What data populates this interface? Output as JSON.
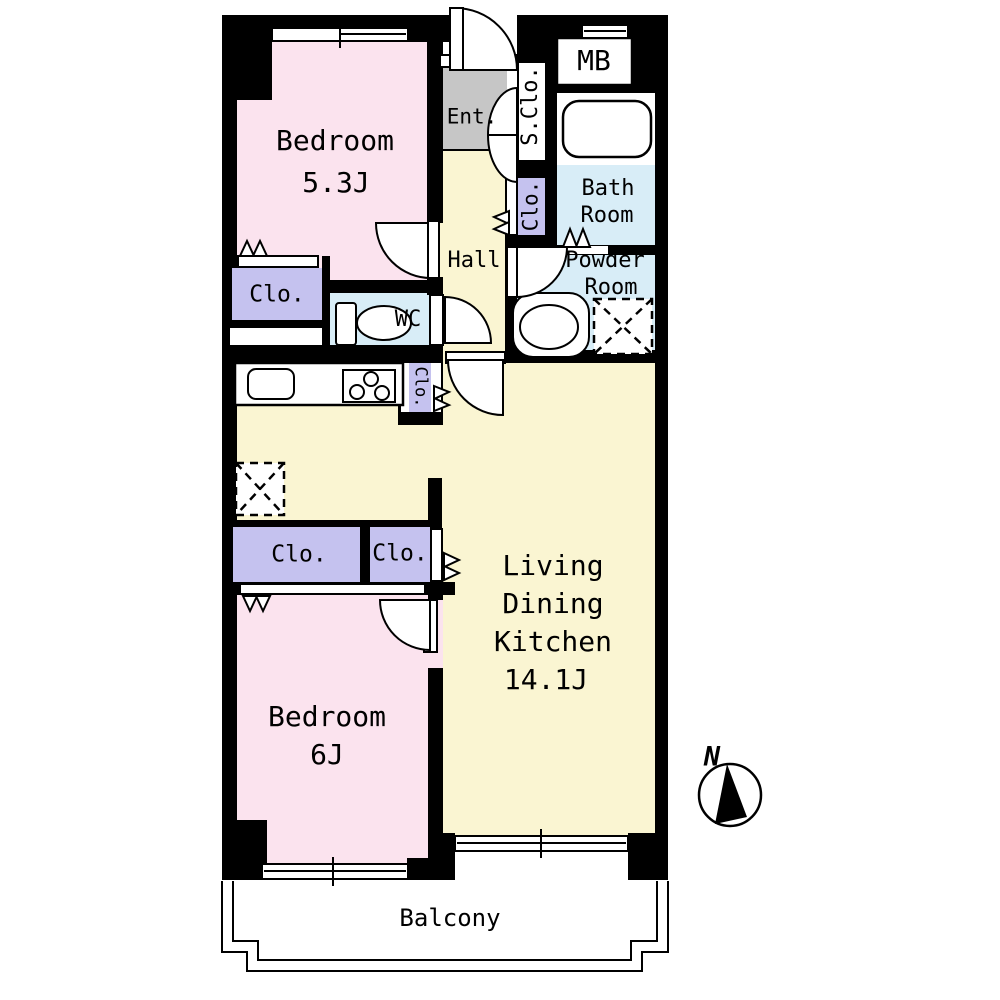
{
  "rooms": {
    "bedroom_1": {
      "name": "Bedroom",
      "area": "5.3J"
    },
    "bedroom_2": {
      "name": "Bedroom",
      "area": "6J"
    },
    "living": {
      "line_1": "Living",
      "line_2": "Dining",
      "line_3": "Kitchen",
      "area": "14.1J"
    },
    "hall": {
      "label": "Hall"
    },
    "entrance": {
      "label": "Ent."
    },
    "shoe_closet": {
      "label": "S.Clo."
    },
    "meter_box": {
      "label": "MB"
    },
    "bath": {
      "line_1": "Bath",
      "line_2": "Room"
    },
    "powder": {
      "line_1": "Powder",
      "line_2": "Room"
    },
    "wc": {
      "label": "WC"
    },
    "balcony": {
      "label": "Balcony"
    },
    "closet_bedroom_1": {
      "label": "Clo."
    },
    "closet_bath_side": {
      "label": "Clo."
    },
    "closet_kitchen_side": {
      "label": "Clo."
    },
    "closet_bedroom_2_large": {
      "label": "Clo."
    },
    "closet_bedroom_2_small": {
      "label": "Clo."
    }
  },
  "compass": {
    "north": "N"
  },
  "colors": {
    "wall": "#000000",
    "bedroom_pink": "#fbe3ee",
    "living_yellow": "#faf5d2",
    "water_blue": "#d8edf7",
    "closet_purple": "#c5c2ef",
    "entrance_gray": "#c6c6c6"
  }
}
